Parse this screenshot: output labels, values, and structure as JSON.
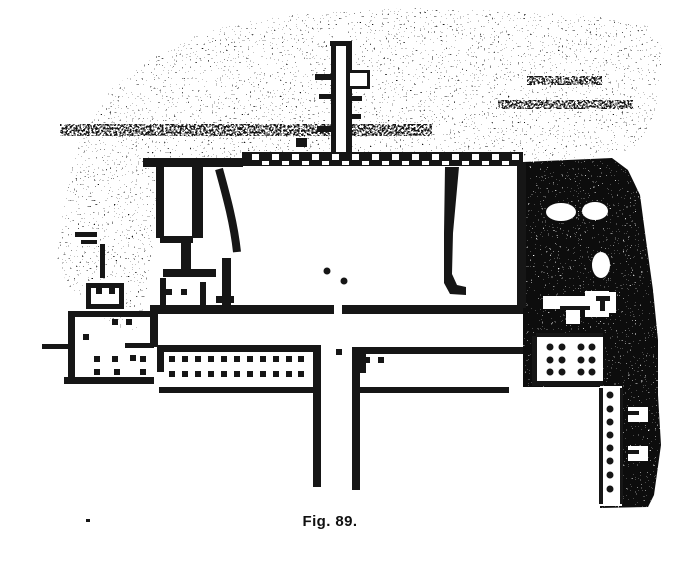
{
  "figure": {
    "caption": "Fig. 89.",
    "ink": "#161616",
    "paper": "#ffffff",
    "canvas": {
      "width": 700,
      "height": 570
    }
  },
  "plan": {
    "textures": [
      {
        "name": "hillside",
        "density": "light",
        "points": "57,258 66,190 80,140 110,90 150,60 190,38 240,22 320,12 420,8 520,12 600,16 648,26 662,48 660,95 648,132 630,150 610,157 523,161 243,159 163,161 156,205 152,252 146,300 136,330 112,326 88,302 68,286"
      },
      {
        "name": "cliff",
        "density": "dense",
        "points": "523,162 612,158 628,170 640,195 646,240 653,290 658,340 658,395 661,445 654,495 648,507 600,508 600,387 523,387"
      },
      {
        "name": "terrace-streak-1",
        "density": "medium",
        "points": "60,124 432,124 432,136 60,136"
      },
      {
        "name": "terrace-streak-2",
        "density": "medium",
        "points": "498,100 633,100 633,109 498,109"
      },
      {
        "name": "terrace-streak-3",
        "density": "medium",
        "points": "527,76 602,76 602,85 527,85"
      }
    ],
    "white_rects": [
      [
        335,
        26,
        13,
        136
      ],
      [
        346,
        68,
        26,
        24
      ],
      [
        73,
        229,
        26,
        17
      ],
      [
        84,
        281,
        42,
        30
      ],
      [
        536,
        336,
        67,
        48
      ],
      [
        600,
        386,
        22,
        120
      ],
      [
        628,
        407,
        20,
        15
      ],
      [
        628,
        446,
        20,
        15
      ],
      [
        543,
        296,
        50,
        13
      ],
      [
        585,
        291,
        24,
        26
      ],
      [
        566,
        308,
        14,
        16
      ],
      [
        588,
        292,
        28,
        21
      ]
    ],
    "white_ellipses": [
      [
        561,
        212,
        15,
        9
      ],
      [
        595,
        211,
        13,
        9
      ],
      [
        601,
        265,
        9,
        13
      ]
    ],
    "walls": [
      [
        143,
        158,
        100,
        9
      ],
      [
        156,
        163,
        8,
        75
      ],
      [
        192,
        165,
        11,
        73
      ],
      [
        160,
        236,
        33,
        7
      ],
      [
        181,
        243,
        10,
        29
      ],
      [
        163,
        269,
        53,
        8
      ],
      [
        100,
        244,
        5,
        34
      ],
      [
        75,
        232,
        22,
        5
      ],
      [
        81,
        240,
        16,
        4
      ],
      [
        86,
        283,
        38,
        5
      ],
      [
        86,
        283,
        5,
        26
      ],
      [
        119,
        283,
        5,
        26
      ],
      [
        86,
        304,
        38,
        5
      ],
      [
        160,
        278,
        6,
        28
      ],
      [
        200,
        282,
        6,
        24
      ],
      [
        216,
        296,
        18,
        7
      ],
      [
        222,
        258,
        9,
        47
      ],
      [
        517,
        162,
        9,
        146
      ],
      [
        150,
        305,
        184,
        9
      ],
      [
        342,
        305,
        181,
        9
      ],
      [
        150,
        305,
        8,
        42
      ],
      [
        330,
        41,
        22,
        5
      ],
      [
        331,
        45,
        5,
        113
      ],
      [
        346,
        45,
        6,
        113
      ],
      [
        315,
        74,
        16,
        6
      ],
      [
        319,
        94,
        13,
        5
      ],
      [
        317,
        126,
        15,
        6
      ],
      [
        351,
        96,
        11,
        5
      ],
      [
        351,
        114,
        10,
        5
      ],
      [
        296,
        138,
        11,
        9
      ],
      [
        347,
        70,
        23,
        19
      ],
      [
        68,
        311,
        86,
        6
      ],
      [
        68,
        311,
        7,
        70
      ],
      [
        64,
        377,
        90,
        7
      ],
      [
        42,
        344,
        26,
        5
      ],
      [
        125,
        343,
        29,
        5
      ],
      [
        157,
        345,
        163,
        7
      ],
      [
        157,
        345,
        7,
        27
      ],
      [
        159,
        387,
        158,
        6
      ],
      [
        313,
        345,
        8,
        142
      ],
      [
        352,
        347,
        8,
        143
      ],
      [
        359,
        347,
        164,
        7
      ],
      [
        359,
        347,
        7,
        26
      ],
      [
        359,
        387,
        150,
        6
      ],
      [
        536,
        333,
        67,
        4
      ],
      [
        532,
        336,
        5,
        50
      ],
      [
        536,
        381,
        67,
        5
      ],
      [
        596,
        296,
        14,
        5
      ],
      [
        600,
        301,
        5,
        10
      ],
      [
        560,
        306,
        30,
        4
      ],
      [
        628,
        411,
        11,
        4
      ],
      [
        628,
        450,
        11,
        4
      ],
      [
        599,
        388,
        4,
        116
      ],
      [
        620,
        388,
        3,
        116
      ]
    ],
    "stroke_paths": [
      {
        "d": "M219,169 C227,198 234,224 237,252",
        "w": 8
      }
    ],
    "fill_polys": [
      "445,167 459,167 453,233 452,274 457,285 466,287 466,295 450,294 444,283 444,233"
    ],
    "niche_wall": {
      "x": 242,
      "y": 152,
      "w": 281,
      "h": 14,
      "notch_w": 7,
      "notch_h": 6,
      "start": 252,
      "step": 20
    },
    "post_whites": [
      [
        350,
        73,
        17,
        13
      ]
    ],
    "square_dot": 6,
    "round_dot_r": 3.5,
    "square_dots": [
      [
        172,
        359
      ],
      [
        185,
        359
      ],
      [
        198,
        359
      ],
      [
        211,
        359
      ],
      [
        224,
        359
      ],
      [
        237,
        359
      ],
      [
        250,
        359
      ],
      [
        263,
        359
      ],
      [
        276,
        359
      ],
      [
        289,
        359
      ],
      [
        301,
        359
      ],
      [
        172,
        374
      ],
      [
        185,
        374
      ],
      [
        198,
        374
      ],
      [
        211,
        374
      ],
      [
        224,
        374
      ],
      [
        237,
        374
      ],
      [
        250,
        374
      ],
      [
        263,
        374
      ],
      [
        276,
        374
      ],
      [
        289,
        374
      ],
      [
        301,
        374
      ],
      [
        367,
        360
      ],
      [
        381,
        360
      ],
      [
        339,
        352
      ],
      [
        115,
        322
      ],
      [
        129,
        322
      ],
      [
        86,
        337
      ],
      [
        97,
        359
      ],
      [
        115,
        359
      ],
      [
        133,
        358
      ],
      [
        143,
        359
      ],
      [
        97,
        372
      ],
      [
        117,
        372
      ],
      [
        143,
        372
      ],
      [
        99,
        291
      ],
      [
        112,
        291
      ],
      [
        169,
        292
      ],
      [
        184,
        292
      ]
    ],
    "round_dots": [
      [
        327,
        271
      ],
      [
        344,
        281
      ],
      [
        550,
        347
      ],
      [
        562,
        347
      ],
      [
        581,
        347
      ],
      [
        592,
        347
      ],
      [
        550,
        360
      ],
      [
        562,
        360
      ],
      [
        581,
        360
      ],
      [
        592,
        360
      ],
      [
        550,
        372
      ],
      [
        562,
        372
      ],
      [
        581,
        372
      ],
      [
        592,
        372
      ],
      [
        610,
        395
      ],
      [
        610,
        409
      ],
      [
        610,
        422
      ],
      [
        610,
        435
      ],
      [
        610,
        448
      ],
      [
        610,
        461
      ],
      [
        610,
        475
      ],
      [
        610,
        489
      ]
    ],
    "specks": [
      [
        86,
        519,
        4,
        3
      ]
    ]
  }
}
